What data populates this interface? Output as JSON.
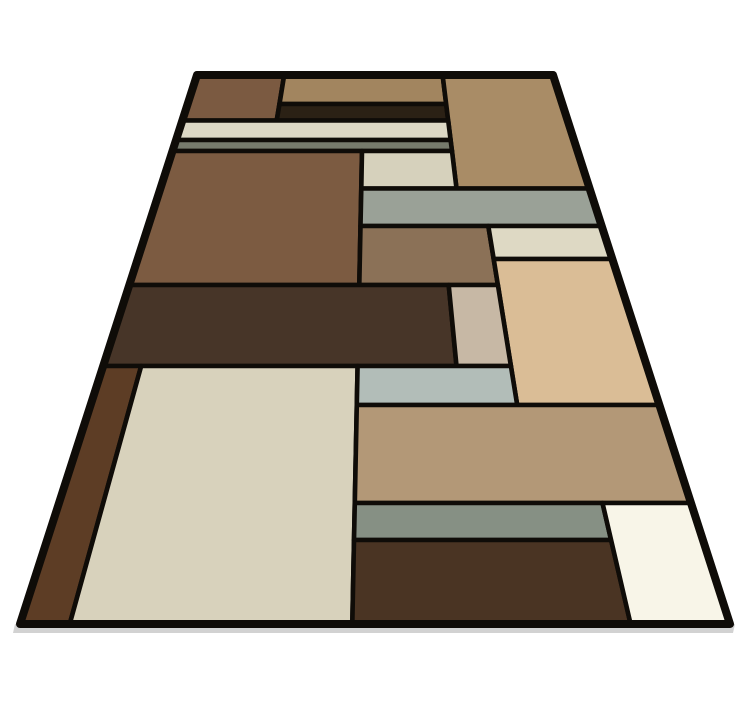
{
  "page": {
    "background_color": "#ffffff"
  },
  "rug": {
    "description_name": "geometric-patchwork-rug",
    "outline_color": "#0f0c08",
    "outline_width": 8,
    "patch_border_color": "#0f0c08",
    "patch_border_width": 4.6,
    "shadow_color": "#c7c7c7",
    "shadow_opacity": 0.8,
    "geometry": {
      "top_y": 75,
      "bottom_y": 624,
      "top_left_x": 197,
      "top_right_x": 553,
      "bottom_left_x": 20,
      "bottom_right_x": 730
    },
    "palette": {
      "medium_brown": "#7c5b41",
      "warm_tan": "#a2855f",
      "dark_chocolate": "#2b2115",
      "camel_tan": "#a98c66",
      "cream": "#d8d2bc",
      "olive_grey": "#767a6c",
      "grey_green": "#9aa197",
      "mocha_brown": "#8b7157",
      "beige_sand": "#dabd96",
      "espresso": "#473528",
      "taupe": "#c7b8a5",
      "saddle_brown": "#5d3d25",
      "blue_grey": "#b2bdb8",
      "light_tan": "#b39877",
      "sage": "#869084",
      "dark_espresso": "#4a3423",
      "ivory_white": "#f8f5e8"
    },
    "patches": [
      {
        "name": "patch-top-left-brown",
        "u1": 0,
        "u2": 0.245,
        "y1": 75,
        "y2": 120.5,
        "fill": "#7b5a41"
      },
      {
        "name": "patch-top-middle-tan",
        "u1": 0.245,
        "u2": 0.69,
        "y1": 75,
        "y2": 104,
        "fill": "#a2855f"
      },
      {
        "name": "patch-dark-chocolate-strip",
        "u1": 0.245,
        "u2": 0.69,
        "y1": 104,
        "y2": 120.5,
        "fill": "#2b2115"
      },
      {
        "name": "patch-top-right-camel",
        "u1": 0.69,
        "u2": 1,
        "y1": 75,
        "y2": 188.5,
        "fill": "#a98c66"
      },
      {
        "name": "patch-cream-strip",
        "u1": 0,
        "u2": 0.69,
        "y1": 120.5,
        "y2": 140,
        "fill": "#dcd8c5"
      },
      {
        "name": "patch-olive-grey-strip",
        "u1": 0,
        "u2": 0.69,
        "y1": 140,
        "y2": 151,
        "fill": "#767a6c"
      },
      {
        "name": "patch-left-brown-large",
        "u1": 0,
        "u2": 0.468,
        "y1": 151,
        "y2": 285,
        "fill": "#7c5b41"
      },
      {
        "name": "patch-cream-block-upper",
        "u1": 0.468,
        "u2": 0.69,
        "y1": 151,
        "y2": 188.5,
        "fill": "#d6d1bc"
      },
      {
        "name": "patch-grey-green-band",
        "u1": 0.468,
        "u2": 1,
        "y1": 188.5,
        "y2": 226,
        "fill": "#9aa197"
      },
      {
        "name": "patch-mocha-block",
        "u1": 0.468,
        "u2": 0.75,
        "y1": 226,
        "y2": 285,
        "fill": "#8b7157"
      },
      {
        "name": "patch-cream-block-right",
        "u1": 0.75,
        "u2": 1,
        "y1": 226,
        "y2": 259,
        "fill": "#ded9c4"
      },
      {
        "name": "patch-beige-block",
        "u1": 0.75,
        "u2": 1,
        "y1": 259,
        "y2": 405,
        "fill": "#dabd96"
      },
      {
        "name": "patch-espresso-row",
        "u1": 0,
        "u2": 0.65,
        "y1": 285,
        "y2": 366,
        "fill": "#473528"
      },
      {
        "name": "patch-taupe-block",
        "u1": 0.65,
        "u2": 0.75,
        "y1": 285,
        "y2": 366,
        "fill": "#c7b8a5"
      },
      {
        "name": "patch-left-edge-strip",
        "u1": 0,
        "u2": 0.07,
        "y1": 366,
        "y2": 624,
        "fill": "#5d3d25"
      },
      {
        "name": "patch-cream-block-bottom",
        "u1": 0.07,
        "u2": 0.468,
        "y1": 366,
        "y2": 624,
        "fill": "#d8d2bc"
      },
      {
        "name": "patch-blue-grey-band",
        "u1": 0.468,
        "u2": 0.75,
        "y1": 366,
        "y2": 405,
        "fill": "#b2bdb8"
      },
      {
        "name": "patch-light-tan-wide",
        "u1": 0.468,
        "u2": 1,
        "y1": 405,
        "y2": 503,
        "fill": "#b39877"
      },
      {
        "name": "patch-sage-band",
        "u1": 0.468,
        "u2": 0.86,
        "y1": 503,
        "y2": 540,
        "fill": "#869084"
      },
      {
        "name": "patch-espresso-bottom",
        "u1": 0.468,
        "u2": 0.86,
        "y1": 540,
        "y2": 624,
        "fill": "#4a3423"
      },
      {
        "name": "patch-ivory-block",
        "u1": 0.86,
        "u2": 1,
        "y1": 503,
        "y2": 624,
        "fill": "#f8f5e8"
      }
    ]
  }
}
